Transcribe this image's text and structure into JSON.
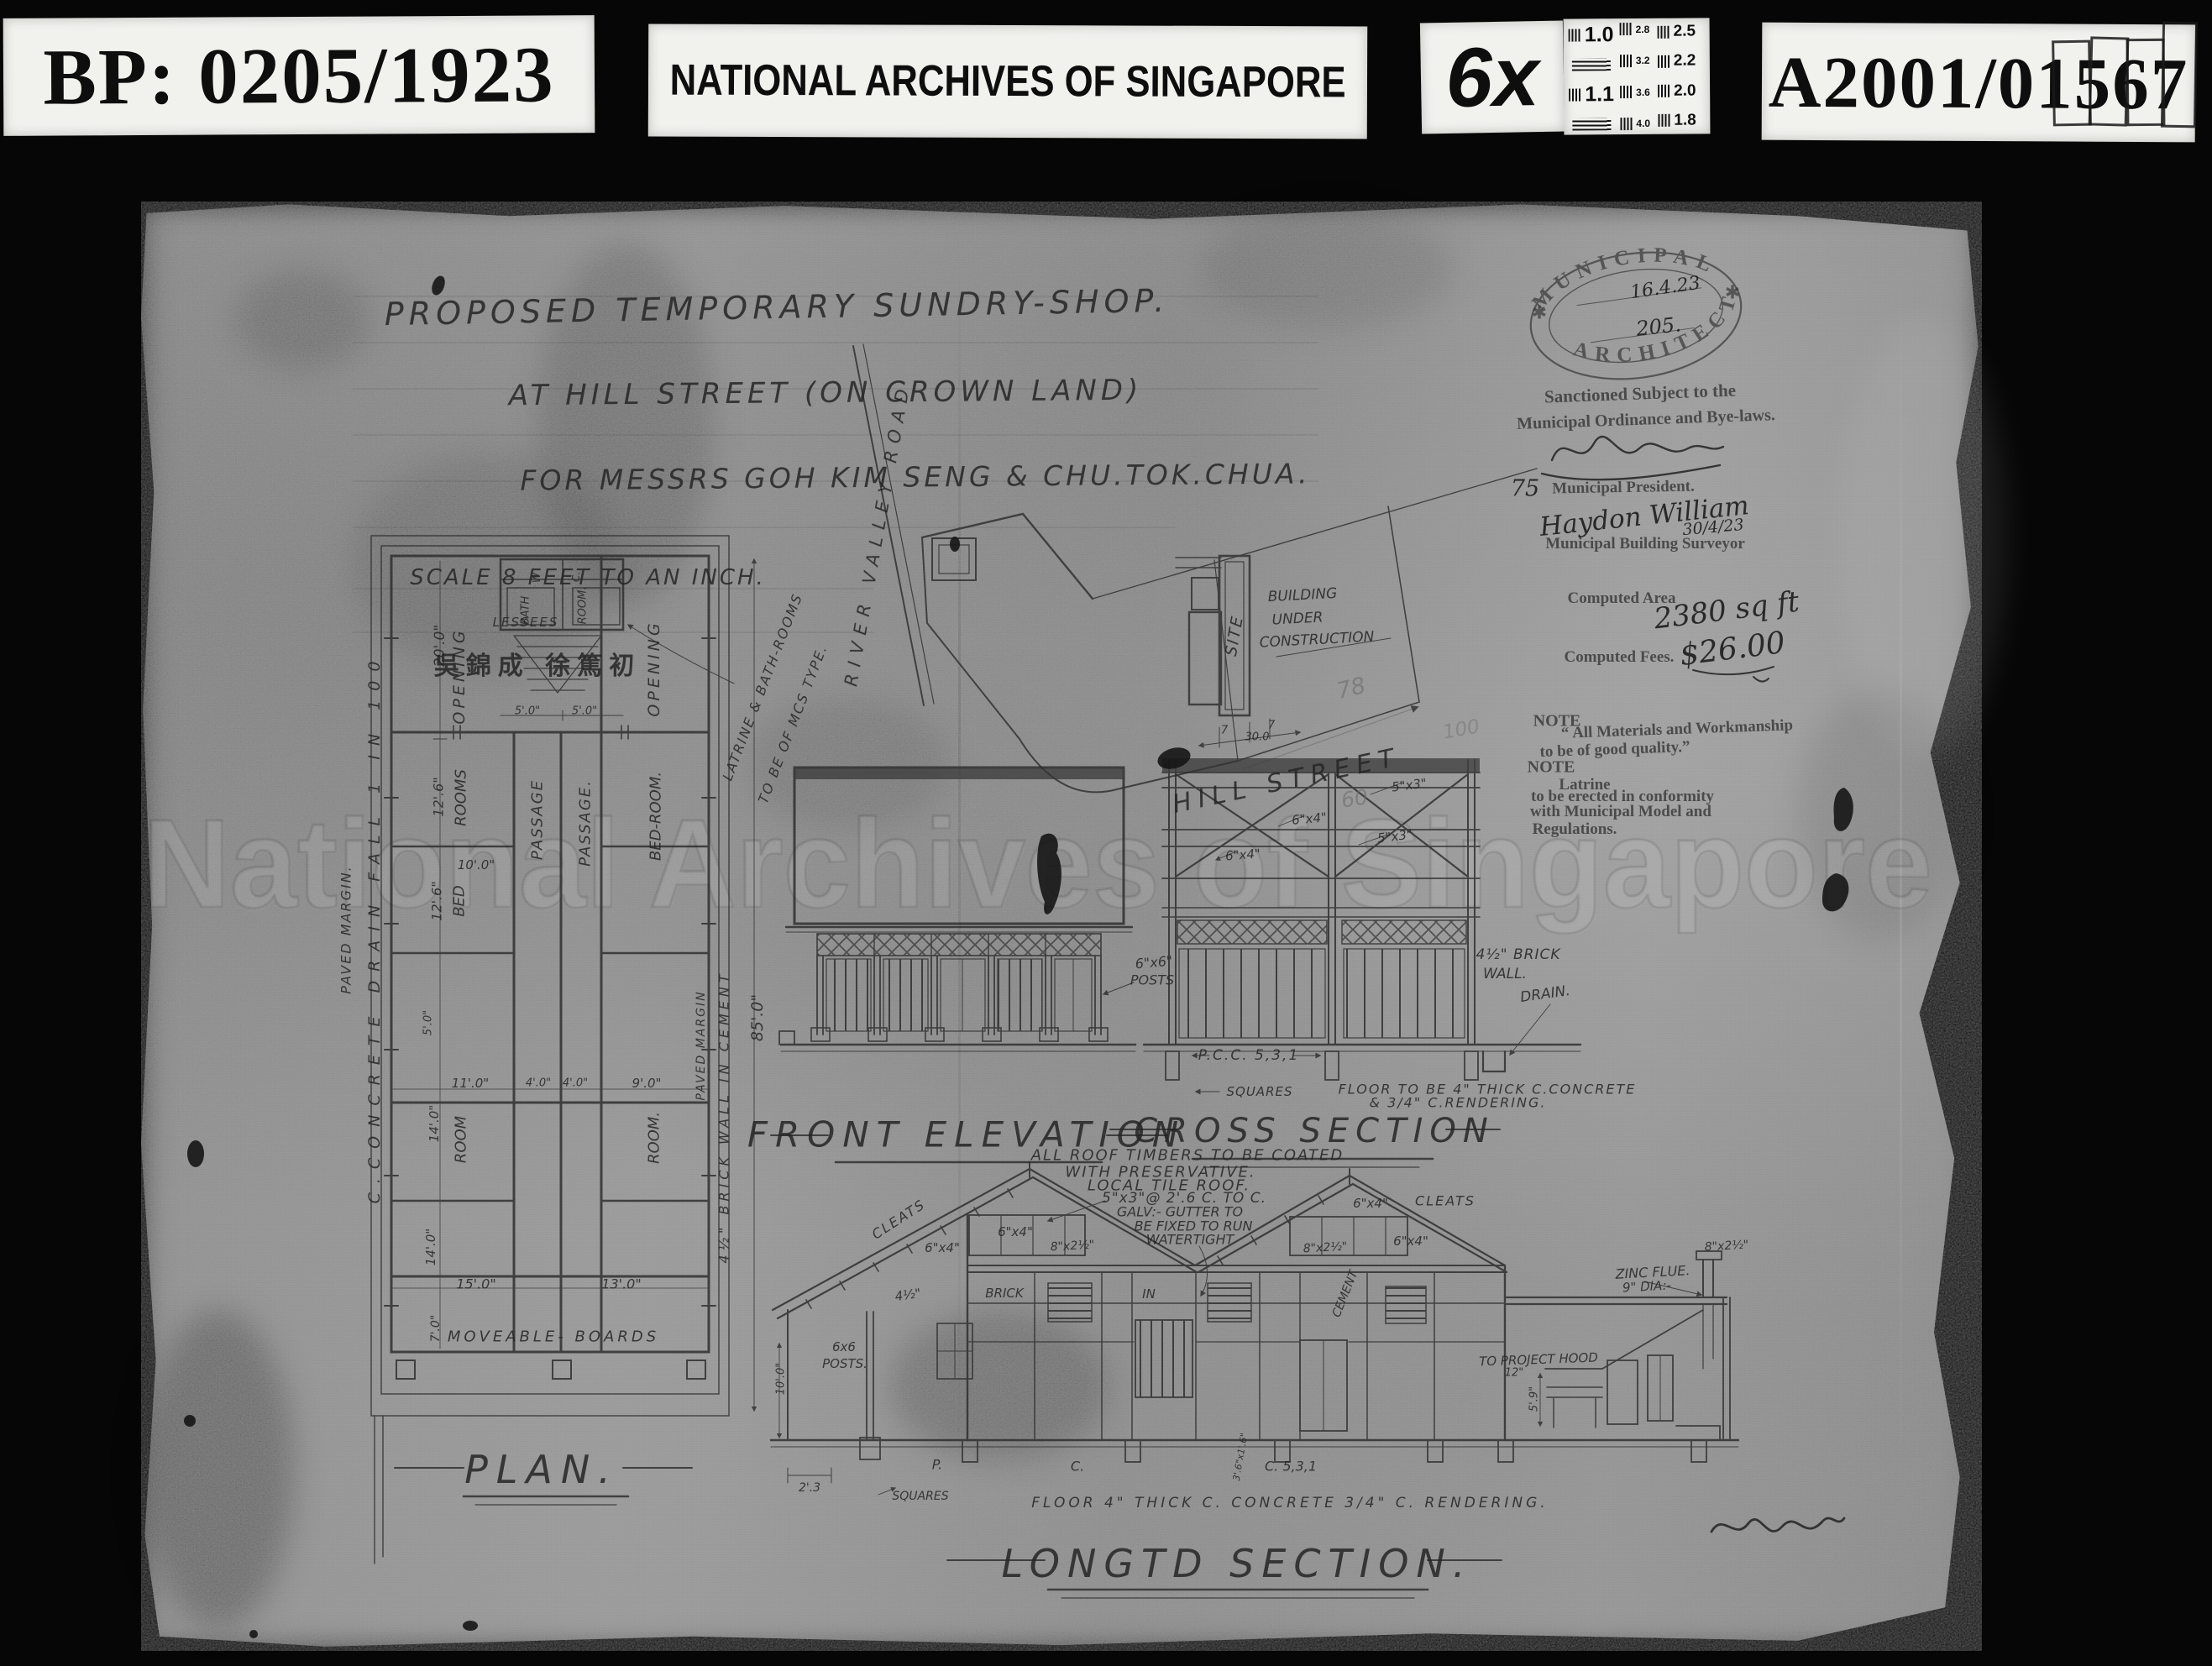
{
  "header": {
    "bp": "BP: 0205/1923",
    "archive": "NATIONAL ARCHIVES OF SINGAPORE",
    "magnification": "6x",
    "reference": "A2001/01567",
    "cal_left": [
      "1.0",
      "1.1"
    ],
    "cal_mid": [
      "2.8",
      "3.2",
      "3.6",
      "4.0"
    ],
    "cal_right": [
      "2.5",
      "2.2",
      "2.0",
      "1.8"
    ]
  },
  "watermark": "National Archives of Singapore",
  "title_block": {
    "line1": "PROPOSED TEMPORARY SUNDRY-SHOP.",
    "line2": "AT HILL STREET (ON CROWN LAND)",
    "line3": "FOR MESSRS GOH  KIM SENG & CHU.TOK.CHUA.",
    "scale_note": "SCALE 8 FEET TO AN INCH.",
    "lessees": "LESSEES",
    "lessees_cjk": "吳錦成  徐篤初"
  },
  "site_plan": {
    "road": "RIVER VALLEY ROAD",
    "street": "HILL STREET",
    "site": "SITE",
    "building1": "BUILDING",
    "building2": "UNDER",
    "building3": "CONSTRUCTION",
    "d78": "78",
    "d100": "100",
    "d60": "60",
    "d30": "30.0",
    "d7a": "7",
    "d7b": "7"
  },
  "plan": {
    "title": "PLAN.",
    "opening_l": "OPENING",
    "opening_r": "OPENING",
    "d20": "20'.0\"",
    "bath": "BATH",
    "room_s": "ROOM.",
    "w": "W",
    "c": "C.",
    "d5a": "5'.0\"",
    "d5b": "5'.0\"",
    "d5c": "5'.0\"",
    "rooms": "ROOMS",
    "d12a": "12'.6\"",
    "d12b": "12'.6\"",
    "d10": "10'.0\"",
    "bed": "BED",
    "passage_a": "PASSAGE",
    "passage_b": "PASSAGE.",
    "bedroom": "BED-ROOM.",
    "d11": "11'.0\"",
    "d4a": "4'.0\"",
    "d4b": "4'.0\"",
    "d9": "9'.0\"",
    "d14a": "14'.0\"",
    "d14b": "14'.0\"",
    "room_a": "ROOM",
    "room_b": "ROOM.",
    "d15": "15'.0\"",
    "d13": "13'.0\"",
    "d7": "7'.0\"",
    "moveable": "MOVEABLE- BOARDS",
    "paved_l": "PAVED MARGIN.",
    "drain": "C.CONCRETE DRAIN FALL 1 IN 100",
    "paved_r": "PAVED MARGIN",
    "brick": "4½\" BRICK WALL IN CEMENT",
    "d85": "85'.0\"",
    "latrine1": "LATRINE & BATH-ROOMS",
    "latrine2": "TO BE OF MCS TYPE."
  },
  "elevation": {
    "title": "FRONT ELEVATION",
    "posts1": "6\"x6\"",
    "posts2": "POSTS"
  },
  "cross": {
    "title": "CROSS SECTION",
    "s53a": "5\"x3\"",
    "s53b": "5\"x3\"",
    "s64a": "6\"x4\"",
    "s64b": "6\"x4\"",
    "brick1": "4½\" BRICK",
    "brick2": "WALL.",
    "drain": "DRAIN.",
    "pcc": "P.C.C. 5,3,1",
    "squares": "SQUARES",
    "floor1": "FLOOR TO BE 4\" THICK C.CONCRETE",
    "floor2": "& 3/4\" C.RENDERING."
  },
  "longsec": {
    "title": "LONGTD SECTION.",
    "n1": "ALL ROOF TIMBERS TO BE COATED",
    "n2": "WITH PRESERVATIVE.",
    "n3": "LOCAL TILE ROOF.",
    "n4": "5\"x3\"@ 2'.6 C. TO C.",
    "n5": "GALV:- GUTTER TO",
    "n6": "BE FIXED TO RUN",
    "n7": "WATERTIGHT",
    "cleats_a": "CLEATS",
    "cleats_b": "CLEATS",
    "s64a": "6\"x4\"",
    "s64b": "6\"x4\"",
    "s64c": "6\"x4\"",
    "s64d": "6\"x4\"",
    "s82a": "8\"x2½\"",
    "s82b": "8\"x2½\"",
    "s82c": "8\"x2½\"",
    "wb1": "4½\"",
    "wb2": "BRICK",
    "wb3": "IN",
    "wb4": "CEMENT",
    "posts1": "6x6",
    "posts2": "POSTS.",
    "zinc1": "ZINC FLUE.",
    "zinc2": "9\" DIA:-",
    "hood1": "TO PROJECT HOOD",
    "hood2": "12\"",
    "d59": "5'.9\"",
    "d10l": "10'.0\"",
    "d23": "2'.3",
    "d36": "3'.6\"x1'.6\"",
    "squares": "SQUARES",
    "floor": "FLOOR 4\" THICK C. CONCRETE 3/4\" C. RENDERING.",
    "p": "P.",
    "c": "C.",
    "c531": "C. 5,3,1"
  },
  "stamp": {
    "oval_top": "MUNICIPAL",
    "oval_bottom": "ARCHITECT",
    "star": "✱",
    "date": "16.4.23",
    "number": "205.",
    "sanction1": "Sanctioned Subject to the",
    "sanction2": "Municipal Ordinance and Bye-laws.",
    "ref": "75",
    "president": "Municipal President.",
    "sig": "Haydon William",
    "sig_date": "30/4/23",
    "surveyor": "Municipal Building Surveyor",
    "area_label": "Computed Area",
    "area_value": "2380 sq ft",
    "fees_label": "Computed Fees.",
    "fees_value": "$26.00",
    "note1_h": "NOTE",
    "note1a": "“ All Materials and Workmanship",
    "note1b": "to be of good quality.”",
    "note2_h": "NOTE",
    "note2a": "Latrine",
    "note2b": "to be erected in conformity",
    "note2c": "with Municipal Model and",
    "note2d": "Regulations."
  }
}
